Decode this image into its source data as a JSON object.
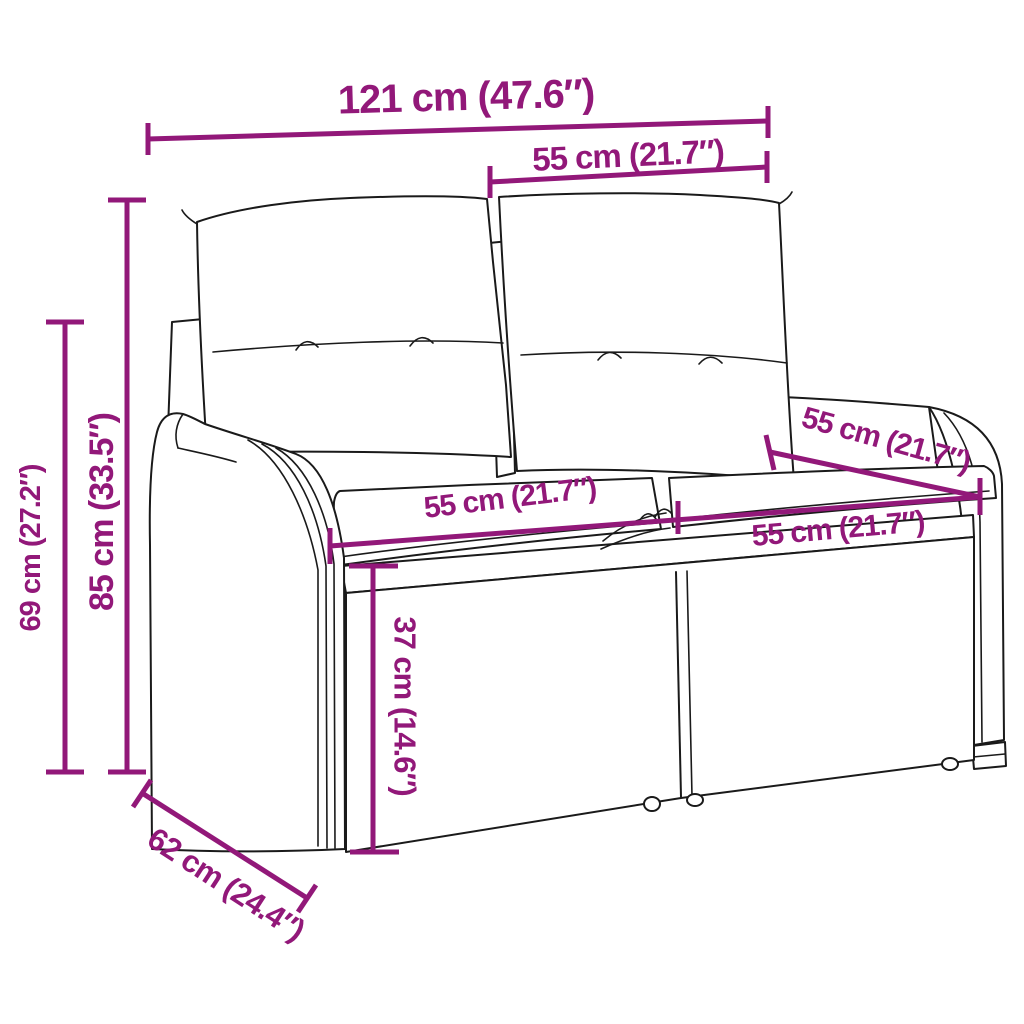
{
  "diagram": {
    "type": "product-dimension-diagram",
    "colors": {
      "accent": "#921879",
      "line": "#1A1A1A",
      "background": "#FFFFFF"
    },
    "dimensions": [
      {
        "id": "overall-width",
        "label": "121 cm (47.6″)"
      },
      {
        "id": "backrest-section-width",
        "label": "55 cm (21.7″)"
      },
      {
        "id": "total-height",
        "label": "85 cm (33.5″)"
      },
      {
        "id": "armrest-height",
        "label": "69 cm (27.2″)"
      },
      {
        "id": "seat-left-width",
        "label": "55 cm (21.7″)"
      },
      {
        "id": "seat-right-width",
        "label": "55 cm (21.7″)"
      },
      {
        "id": "seat-depth",
        "label": "55 cm (21.7″)"
      },
      {
        "id": "seat-height",
        "label": "37 cm (14.6″)"
      },
      {
        "id": "overall-depth",
        "label": "62 cm (24.4″)"
      }
    ]
  }
}
